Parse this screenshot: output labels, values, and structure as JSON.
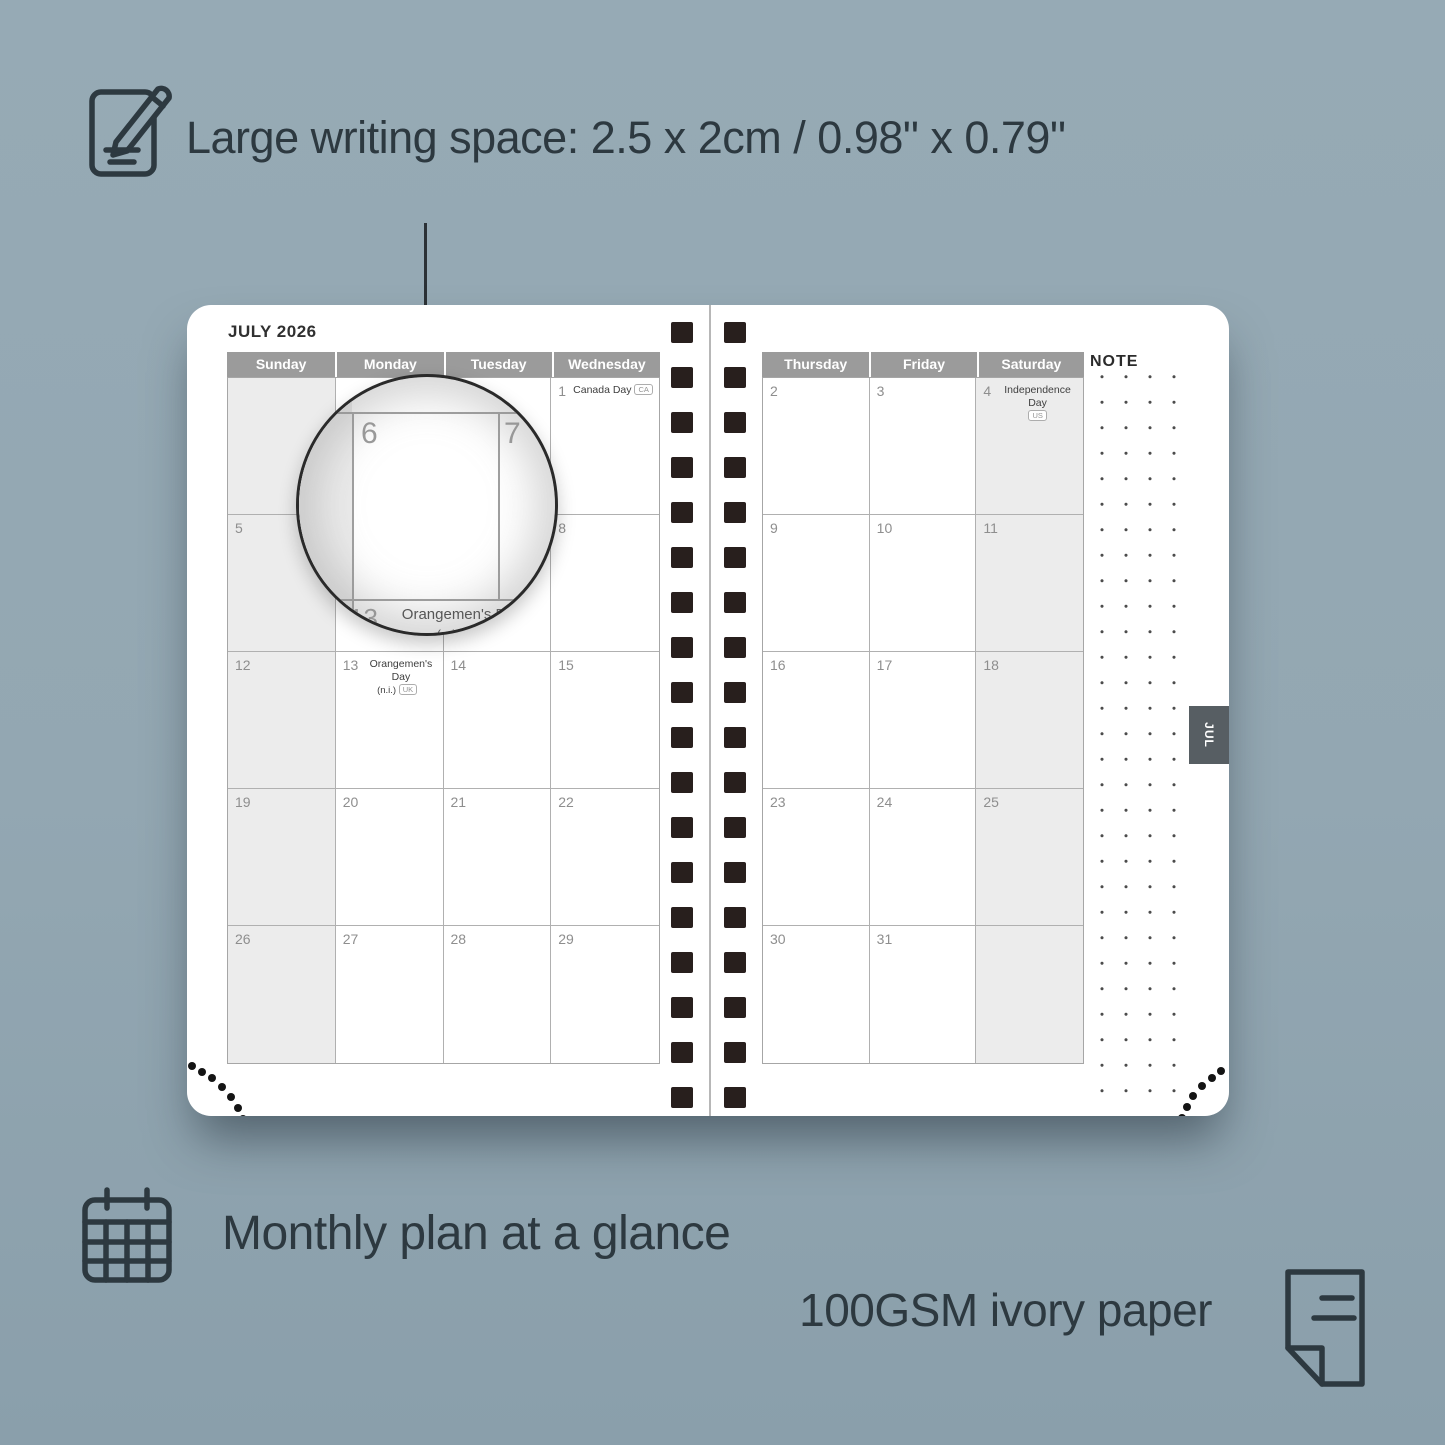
{
  "features": {
    "writing_space": "Large writing space: 2.5 x 2cm / 0.98\" x 0.79\"",
    "monthly_glance": "Monthly plan at a glance",
    "paper": "100GSM ivory paper"
  },
  "planner": {
    "month_title": "JULY 2026",
    "note_label": "NOTE",
    "side_tab": "JUL",
    "left_page": {
      "headers": [
        "Sunday",
        "Monday",
        "Tuesday",
        "Wednesday"
      ],
      "shaded_column": 0,
      "rows": [
        [
          {
            "day": ""
          },
          {
            "day": ""
          },
          {
            "day": ""
          },
          {
            "day": "1",
            "holiday": "Canada Day",
            "badge": "CA",
            "badge_line": 1
          }
        ],
        [
          {
            "day": "5"
          },
          {
            "day": "6"
          },
          {
            "day": "7"
          },
          {
            "day": "8"
          }
        ],
        [
          {
            "day": "12"
          },
          {
            "day": "13",
            "holiday": "Orangemen's Day",
            "sub": "(n.i.)",
            "badge": "UK",
            "badge_line": 2
          },
          {
            "day": "14"
          },
          {
            "day": "15"
          }
        ],
        [
          {
            "day": "19"
          },
          {
            "day": "20"
          },
          {
            "day": "21"
          },
          {
            "day": "22"
          }
        ],
        [
          {
            "day": "26"
          },
          {
            "day": "27"
          },
          {
            "day": "28"
          },
          {
            "day": "29"
          }
        ]
      ]
    },
    "right_page": {
      "headers": [
        "Thursday",
        "Friday",
        "Saturday"
      ],
      "shaded_column": 2,
      "rows": [
        [
          {
            "day": "2"
          },
          {
            "day": "3"
          },
          {
            "day": "4",
            "holiday": "Independence Day",
            "badge": "US",
            "badge_line": 2
          }
        ],
        [
          {
            "day": "9"
          },
          {
            "day": "10"
          },
          {
            "day": "11"
          }
        ],
        [
          {
            "day": "16"
          },
          {
            "day": "17"
          },
          {
            "day": "18"
          }
        ],
        [
          {
            "day": "23"
          },
          {
            "day": "24"
          },
          {
            "day": "25"
          }
        ],
        [
          {
            "day": "30"
          },
          {
            "day": "31"
          },
          {
            "day": ""
          }
        ]
      ]
    },
    "magnifier": {
      "left_day": "6",
      "right_day": "7",
      "bottom_day": "13",
      "bottom_holiday": "Orangemen's Day",
      "bottom_sub": "(n.i.)",
      "bottom_badge": "UK"
    }
  },
  "colors": {
    "background": "#93a7b2",
    "background_top": "#96aab5",
    "background_bottom": "#8a9fab",
    "ink": "#2d3940",
    "header_bg": "#9b9b9b",
    "shaded_cell": "#ececec",
    "tab_bg": "#575e63",
    "spiral": "#281f1d"
  }
}
